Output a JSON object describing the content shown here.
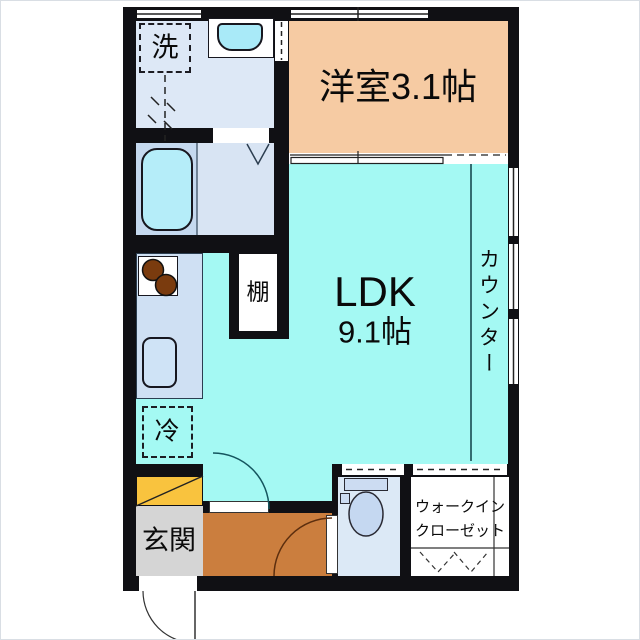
{
  "floorplan": {
    "rooms": {
      "western_room": {
        "label": "洋室3.1帖"
      },
      "ldk": {
        "name": "LDK",
        "size": "9.1帖"
      },
      "counter": {
        "label": "カウンター"
      },
      "entrance": {
        "label": "玄関"
      },
      "walk_in_closet": {
        "label_line1": "ウォークイン",
        "label_line2": "クローゼット"
      }
    },
    "fixtures": {
      "washing_machine": {
        "label": "洗"
      },
      "refrigerator": {
        "label": "冷"
      },
      "shelf": {
        "label": "棚"
      }
    },
    "colors": {
      "wall": "#101014",
      "ldk_floor": "#a4f9f3",
      "western_room_floor": "#f6cba3",
      "hall_floor": "#cb7e3e",
      "entrance_floor": "#d5d5d5",
      "shoe_cabinet": "#f9c33e",
      "washroom_floor": "#dde8f6",
      "bathroom_floor": "#c5d9ef",
      "toilet_floor": "#dce9f6",
      "kitchen_counter": "#cfe0f3",
      "bathtub": "#b5edf9",
      "closet_floor": "#ffffff"
    }
  }
}
